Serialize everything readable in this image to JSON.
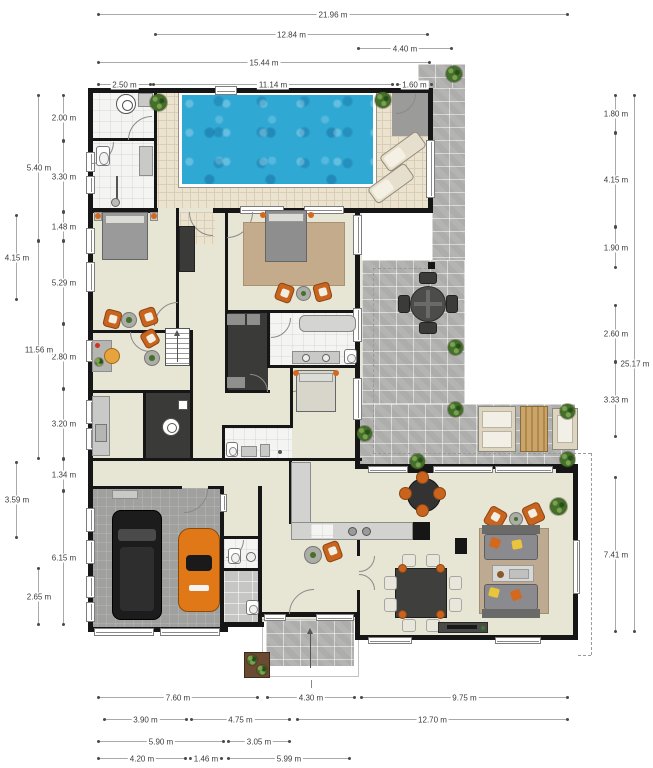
{
  "drawing": {
    "type": "residential-floor-plan",
    "units": "m",
    "visible_text_is_dimensions_only": true
  },
  "colors": {
    "wall": "#161616",
    "floor_beige": "#e7e5d3",
    "deck_tile": "#ece3cf",
    "white_tile": "#f4f4f2",
    "paver_gray": "#b4b4b2",
    "garage_floor": "#a0a09e",
    "pool_water": "#2fa8d4",
    "closet_dark": "#3a3a38",
    "accent_chair_orange": "#c8641e",
    "rug_tan": "#c3ab8b",
    "wood": "#c9a46b",
    "dimension_text": "#3c3c3c"
  },
  "dimensions": {
    "top": [
      {
        "label": "21.96 m"
      },
      {
        "label": "12.84 m"
      },
      {
        "label": "4.40 m"
      },
      {
        "label": "15.44 m"
      },
      {
        "label": "2.50 m"
      },
      {
        "label": "11.14 m"
      },
      {
        "label": "1.60 m"
      }
    ],
    "bottom": [
      {
        "label": "7.60 m"
      },
      {
        "label": "4.30 m"
      },
      {
        "label": "9.75 m"
      },
      {
        "label": "3.90 m"
      },
      {
        "label": "4.75 m"
      },
      {
        "label": "12.70 m"
      },
      {
        "label": "5.90 m"
      },
      {
        "label": "3.05 m"
      },
      {
        "label": "4.20 m"
      },
      {
        "label": "1.46 m"
      },
      {
        "label": "5.99 m"
      }
    ],
    "left": [
      {
        "label": "2.00 m"
      },
      {
        "label": "5.40 m"
      },
      {
        "label": "3.30 m"
      },
      {
        "label": "1.48 m"
      },
      {
        "label": "4.15 m"
      },
      {
        "label": "5.29 m"
      },
      {
        "label": "2.80 m"
      },
      {
        "label": "11.56 m"
      },
      {
        "label": "3.20 m"
      },
      {
        "label": "1.34 m"
      },
      {
        "label": "3.59 m"
      },
      {
        "label": "6.15 m"
      },
      {
        "label": "2.65 m"
      }
    ],
    "right": [
      {
        "label": "1.80 m"
      },
      {
        "label": "4.15 m"
      },
      {
        "label": "1.90 m"
      },
      {
        "label": "2.60 m"
      },
      {
        "label": "25.17 m"
      },
      {
        "label": "3.33 m"
      },
      {
        "label": "7.41 m"
      }
    ]
  },
  "icons": {
    "washer": "washing-machine circle glyph",
    "toilet": "toilet glyph",
    "shower": "shower head glyph",
    "cooktop": "two burner circles",
    "plant": "potted plant circle",
    "entrance_arrow": "up arrow at front door",
    "stairs_arrow": "up arrow on staircase"
  }
}
